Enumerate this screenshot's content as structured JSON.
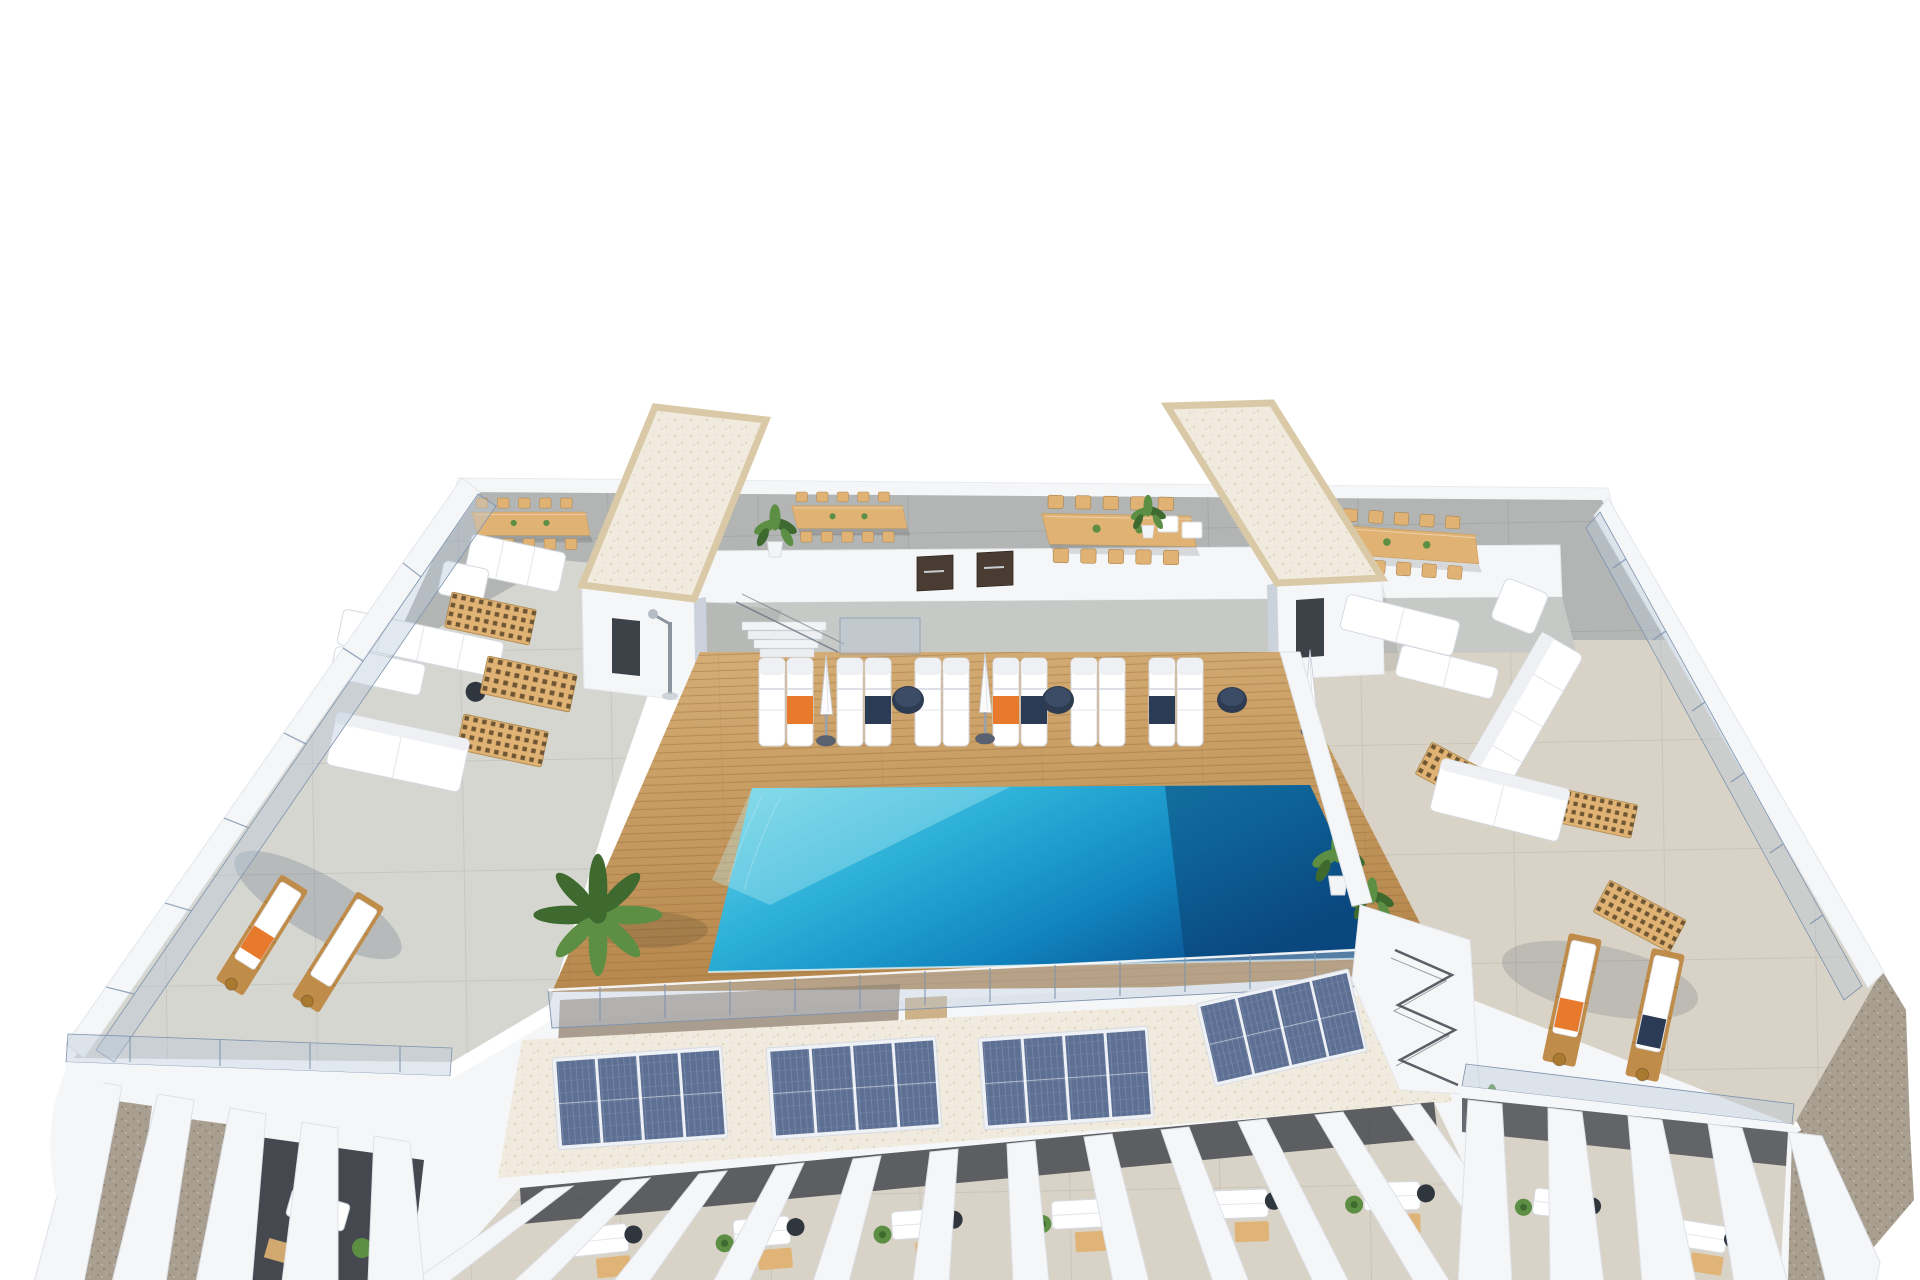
{
  "scene": {
    "type": "architectural-3d-render",
    "description": "Aerial 3D visualization of a white Mediterranean apartment building rooftop: central timber pool deck with a turquoise infinity pool and rows of white sun loungers with orange and navy towels, closed parasols and round navy side tables, flanked by two stair towers with cream gravel flat roofs; communal dining terraces with timber tables and chairs along the back wall with dark storage doors; left and right resident terraces with white outdoor sofas, double sunbeds, timber lattice skylights and wooden loungers behind glass balustrades; a lower service roof in front of the pool carrying four photovoltaic solar arrays on white gravel; white pergola fins over private furnished balconies along the lower edge; brown gravel terrain strips at the outer edges; pure white background.",
    "view": "elevated three-quarter aerial view",
    "background": "white"
  },
  "objects": {
    "stair_towers": 2,
    "tower_roof_finish": "cream gravel with beige border",
    "dining_sets": 4,
    "chairs_per_dining_set": 10,
    "storage_doors": 2,
    "tower_doors": 2,
    "pool": {
      "count": 1,
      "water": "turquoise to deep navy gradient, infinity edge at front"
    },
    "deck_loungers": 12,
    "closed_parasols": 3,
    "round_side_tables": 3,
    "towels": {
      "orange": 4,
      "navy": 4
    },
    "outdoor_shower": 1,
    "deck_stairs": 1,
    "solar_arrays": 4,
    "panels_per_array": 4,
    "pergola_fins": 22,
    "timber_loungers": 4,
    "lattice_skylights": 6,
    "sofa_sets": 3,
    "double_sunbeds": 2,
    "flat_cushion_beds": 2,
    "balcony_furniture_clusters": 9,
    "potted_plants": 17,
    "glass_balustrades": "around pool deck, wing terraces and outer parapets",
    "stair_gap_with_zigzag_railing": 1
  },
  "colors": {
    "background": "#ffffff",
    "white": "#f5f6f8",
    "wall_shadow": "#ccd2db",
    "floor_top": "#b2b5b4",
    "concrete_mid": "#c7c9c6",
    "floor_left": "#d6d6d1",
    "floor_travertine": "#d9d3c7",
    "gravel_roof": "#f1ebdf",
    "gravel_border": "#d9c9a7",
    "terrain": "#a89f90",
    "glass": "#b9c7d9",
    "glass_edge": "#7e93ad",
    "deck_light": "#d6ae76",
    "deck_dark": "#b6874c",
    "plank_line": "#8f6b3c",
    "wood_furniture": "#e0b273",
    "wood_lounger": "#c08c4a",
    "solar_panel": "#5d7093",
    "solar_frame": "#eef1f5",
    "green": "#5c8f44",
    "green_dark": "#3e692f",
    "door_brown": "#4a3c33",
    "tower_door": "#3d4148",
    "interior_dark": "#45494f",
    "navy_towel": "#2b3a55",
    "orange_towel": "#e87a2e",
    "table_navy": "#2e3c52",
    "pool_light": "#6fd4e6",
    "pool_mid": "#2bb0d8",
    "pool_deep": "#1186c0",
    "pool_navy": "#0a5190",
    "metal": "#8b949f"
  }
}
